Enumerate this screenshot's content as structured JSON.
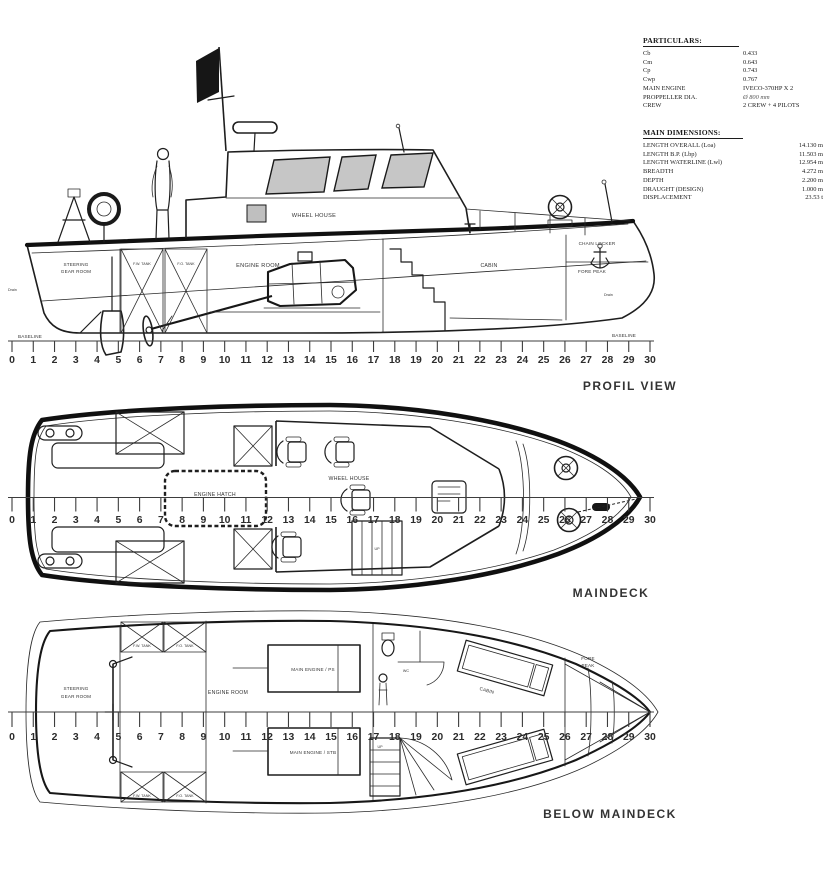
{
  "colors": {
    "ink": "#1e1e1e",
    "window_fill": "#c6c6c6",
    "flag": "#161616"
  },
  "particulars": {
    "title": "PARTICULARS:",
    "rows": [
      {
        "label": "Cb",
        "value": "0.433"
      },
      {
        "label": "Cm",
        "value": "0.643"
      },
      {
        "label": "Cp",
        "value": "0.743"
      },
      {
        "label": "Cwp",
        "value": "0.767"
      },
      {
        "label": "MAIN ENGINE",
        "value": "IVECO-370HP X 2"
      },
      {
        "label": "PROPPELLER DIA.",
        "value": "Ø 800 mm"
      },
      {
        "label": "CREW",
        "value": "2 CREW + 4 PILOTS"
      }
    ]
  },
  "main_dimensions": {
    "title": "MAIN DIMENSIONS:",
    "rows": [
      {
        "label": "LENGTH OVERALL  (Loa)",
        "value": "14.130 m"
      },
      {
        "label": "LENGTH B.P.  (Lbp)",
        "value": "11.503 m"
      },
      {
        "label": "LENGTH WATERLINE  (Lwl)",
        "value": "12.954 m"
      },
      {
        "label": "BREADTH",
        "value": "4.272 m"
      },
      {
        "label": "DEPTH",
        "value": "2.200 m"
      },
      {
        "label": "DRAUGHT (DESIGN)",
        "value": "1.000 m"
      },
      {
        "label": "DISPLACEMENT",
        "value": "23.53 t"
      }
    ]
  },
  "profile_view": {
    "title": "PROFIL VIEW",
    "baseline_left": "BASELINE",
    "baseline_right": "BASELINE",
    "steering_line1": "STEERING",
    "steering_line2": "GEAR ROOM",
    "tank1": "F.W. TANK",
    "tank2": "F.O. TANK",
    "engine_room": "ENGINE ROOM",
    "wheel_house": "WHEEL HOUSE",
    "cabin": "CABIN",
    "chain_locker": "CHAIN LOCKER",
    "fore_peak": "FORE PEAK",
    "drain_left": "Drain",
    "drain_right": "Drain"
  },
  "maindeck_view": {
    "title": "MAINDECK",
    "engine_hatch": "ENGINE HATCH",
    "wheel_house": "WHEEL HOUSE",
    "up": "UP"
  },
  "below_view": {
    "title": "BELOW MAINDECK",
    "steering_line1": "STEERING",
    "steering_line2": "GEAR ROOM",
    "engine_room": "ENGINE ROOM",
    "main_engine_ps": "MAIN ENGINE / PS",
    "main_engine_stb": "MAIN ENGINE / STB",
    "wc": "WC",
    "cabin": "CABIN",
    "fore_peak_line1": "FORE",
    "fore_peak_line2": "PEAK",
    "tank_fw": "F.W. TANK",
    "tank_fo": "F.O. TANK",
    "up": "UP"
  },
  "rulers": {
    "profile": {
      "start": 0,
      "end": 30
    },
    "maindeck": {
      "start": 0,
      "end": 30
    },
    "below_maindeck": {
      "start": 0,
      "end": 30
    }
  }
}
